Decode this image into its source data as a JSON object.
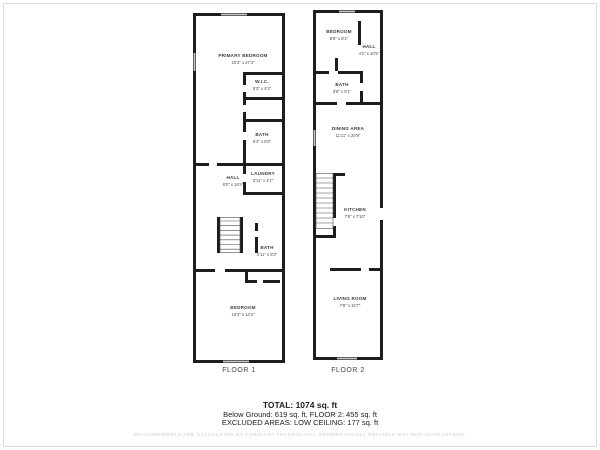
{
  "floor1": {
    "label": "FLOOR 1",
    "rooms": {
      "primary_bedroom": {
        "name": "PRIMARY BEDROOM",
        "dims": "10'3\" x 27'3\""
      },
      "wic": {
        "name": "W.I.C.",
        "dims": "5'3\" x 4'2\""
      },
      "bath_upper": {
        "name": "BATH",
        "dims": "5'3\" x 8'2\""
      },
      "hall": {
        "name": "HALL",
        "dims": "6'0\" x 18'4\""
      },
      "laundry": {
        "name": "LAUNDRY",
        "dims": "2'11\" x 4'1\""
      },
      "bath_lower": {
        "name": "BATH",
        "dims": "2'11\" x 9'2\""
      },
      "bedroom": {
        "name": "BEDROOM",
        "dims": "10'3\" x 14'4\""
      }
    }
  },
  "floor2": {
    "label": "FLOOR 2",
    "rooms": {
      "bedroom": {
        "name": "BEDROOM",
        "dims": "8'8\" x 8'1\""
      },
      "hall": {
        "name": "HALL",
        "dims": "4'1\" x 10'5\""
      },
      "bath": {
        "name": "BATH",
        "dims": "8'8\" x 5'1\""
      },
      "dining": {
        "name": "DINING AREA",
        "dims": "11'11\" x 20'9\""
      },
      "kitchen": {
        "name": "KITCHEN",
        "dims": "7'8\" x 7'10\""
      },
      "living": {
        "name": "LIVING ROOM",
        "dims": "7'8\" x 15'7\""
      }
    }
  },
  "summary": {
    "total": "TOTAL: 1074 sq. ft",
    "below_ground": "Below Ground: 619 sq. ft, FLOOR 2: 455 sq. ft",
    "excluded": "EXCLUDED AREAS: LOW CEILING: 177 sq. ft",
    "disclaimer": "MEASUREMENTS ARE CALCULATED BY CUBICASA TECHNOLOGY. DEEMED HIGHLY RELIABLE BUT NOT GUARANTEED."
  },
  "colors": {
    "wall": "#1d1d1d",
    "window": "#c6c6c6",
    "room_text": "#3c3c3c",
    "floor_label_text": "#444444",
    "disclaimer_text": "#c9c9c9"
  }
}
